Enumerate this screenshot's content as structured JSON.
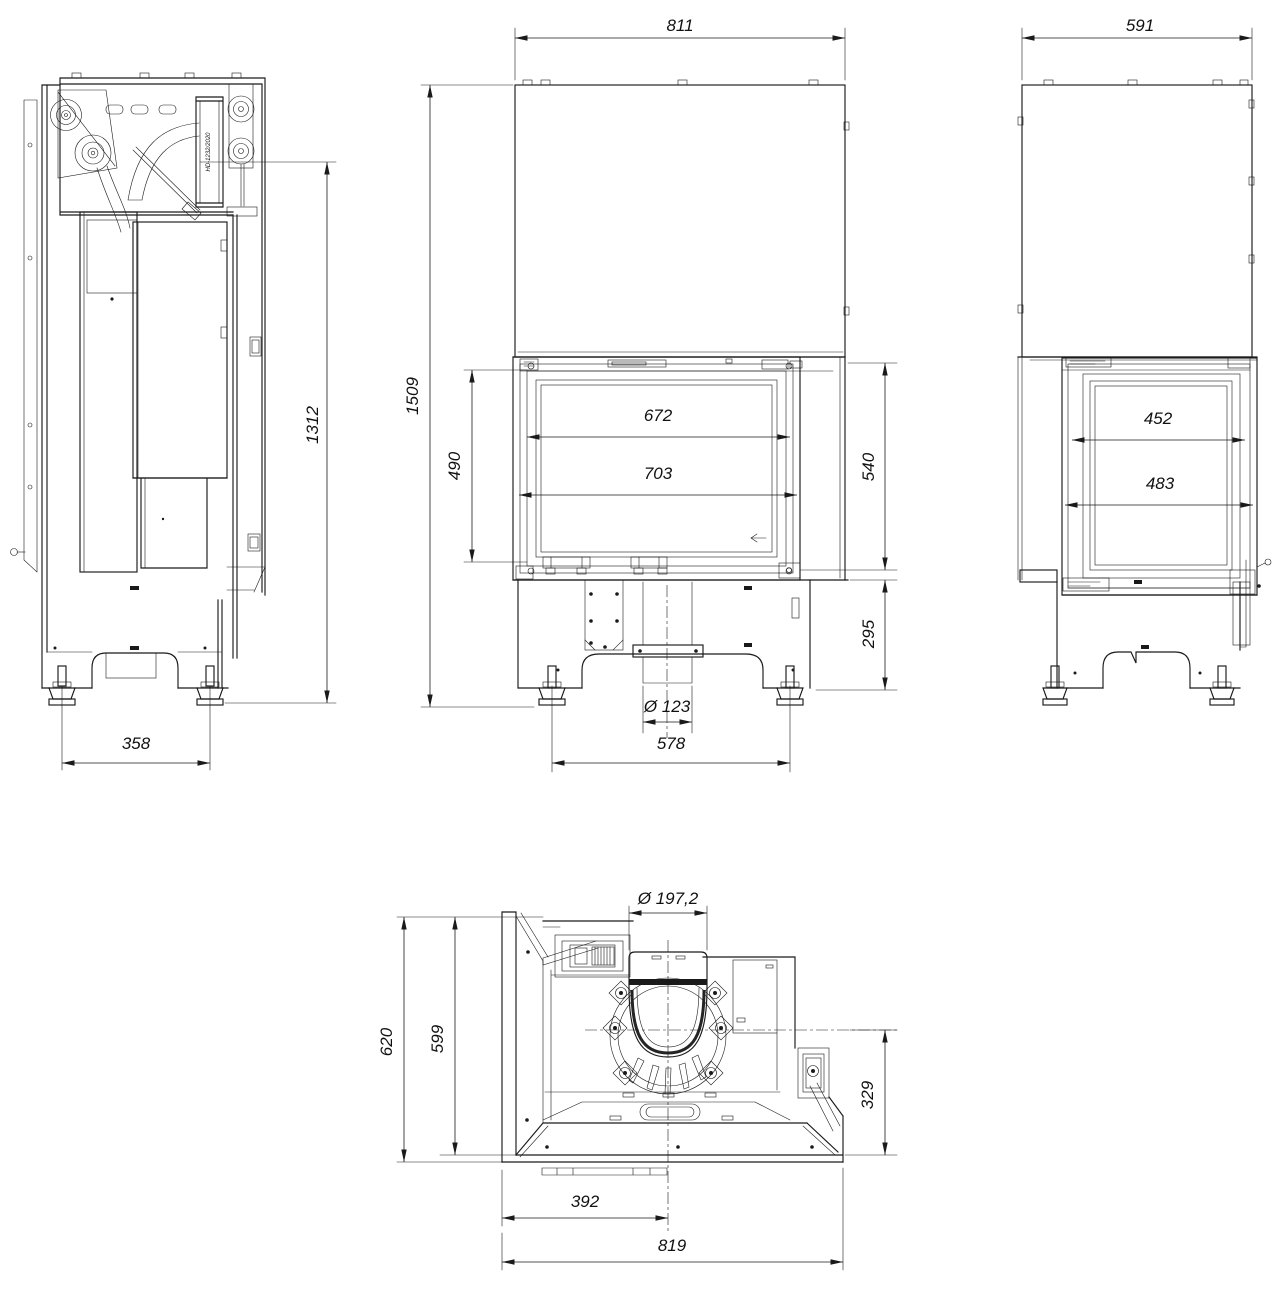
{
  "drawing": {
    "views": {
      "left_side": {
        "part_label": "HD-1232/2020",
        "dims": {
          "mechanism_height": "1312",
          "feet_spacing": "358"
        }
      },
      "front": {
        "dims": {
          "overall_width": "811",
          "overall_height": "1509",
          "glass_height": "490",
          "glass_width_inner": "672",
          "glass_width_outer": "703",
          "firebox_height": "540",
          "base_height": "295",
          "air_inlet_diameter": "Ø 123",
          "feet_spacing": "578"
        }
      },
      "right_side": {
        "dims": {
          "overall_depth": "591",
          "side_glass_width_inner": "452",
          "side_glass_width_outer": "483"
        }
      },
      "top": {
        "dims": {
          "flue_diameter": "Ø 197,2",
          "overall_depth": "620",
          "body_depth": "599",
          "flue_rear_offset": "329",
          "flue_side_offset": "392",
          "overall_width": "819"
        }
      }
    }
  }
}
